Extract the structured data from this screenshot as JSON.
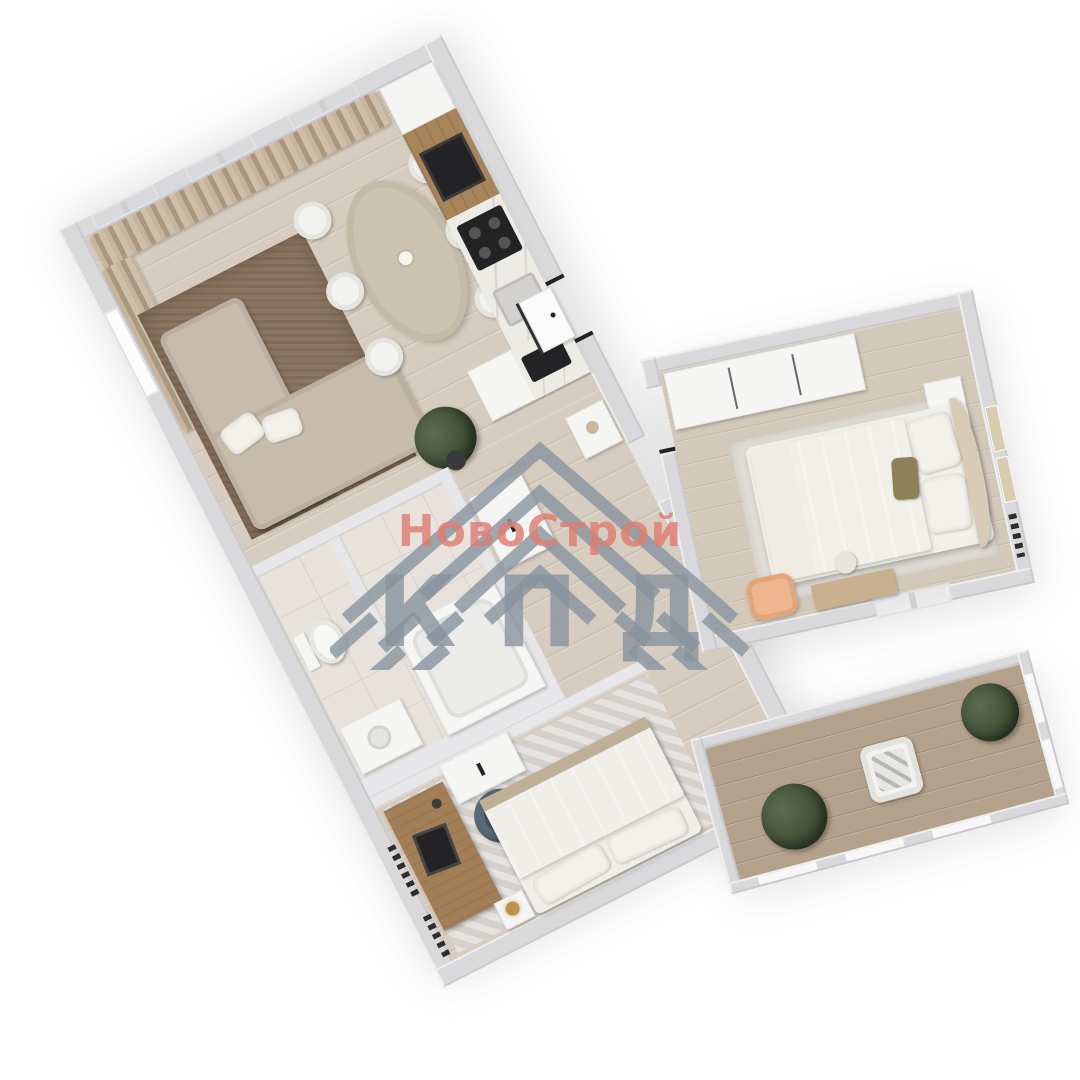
{
  "watermark": {
    "brand_text": "НовоСтрой",
    "abbr_text": "КПД",
    "brand_color": "#de7d70",
    "abbr_color": "#88929d",
    "logo": "nested-chevron-roof-logo",
    "logo_color": "#8b95a1"
  },
  "scene": {
    "type": "3d-floorplan-render",
    "view": "top-down isometric apartment, rotated diagonally on white background",
    "background": "#ffffff",
    "palette": {
      "walls": "#d9d9db",
      "wood_floor": "#d6ccbf",
      "balcony_floor": "#b3a18c",
      "living_rug": "#8c7560",
      "sofa": "#c7bcab",
      "kitchen_wood": "#a8845a",
      "bedding": "#cdc2a7",
      "bedroom_carpet": "#dcd9d4",
      "bathroom_tile": "#e7e3dc",
      "plants": "#44503a",
      "accent_armchair": "#edb68e"
    },
    "rooms": [
      {
        "name": "living-dining-kitchen",
        "items": [
          "corner-sofa",
          "brown-rug",
          "potted-plant",
          "oval-dining-table",
          "six-chairs",
          "curtained-windows",
          "kitchen-cabinets",
          "oven",
          "cooktop",
          "sink-island"
        ]
      },
      {
        "name": "hallway",
        "items": [
          "front-door",
          "console-with-vase",
          "drawer-cabinet"
        ]
      },
      {
        "name": "bathroom",
        "items": [
          "toilet",
          "bathtub",
          "vanity"
        ]
      },
      {
        "name": "bedroom-1",
        "items": [
          "desk",
          "laptop",
          "swivel-chair",
          "dresser",
          "double-bed",
          "nightstand-lamp",
          "radiators"
        ]
      },
      {
        "name": "master-bedroom",
        "items": [
          "wardrobe",
          "double-bed",
          "nightstand",
          "wall-frames",
          "peach-armchair",
          "dressing-table",
          "radiator"
        ]
      },
      {
        "name": "balcony",
        "items": [
          "two-bushes",
          "armchair-with-plaid",
          "glazing"
        ]
      }
    ]
  }
}
